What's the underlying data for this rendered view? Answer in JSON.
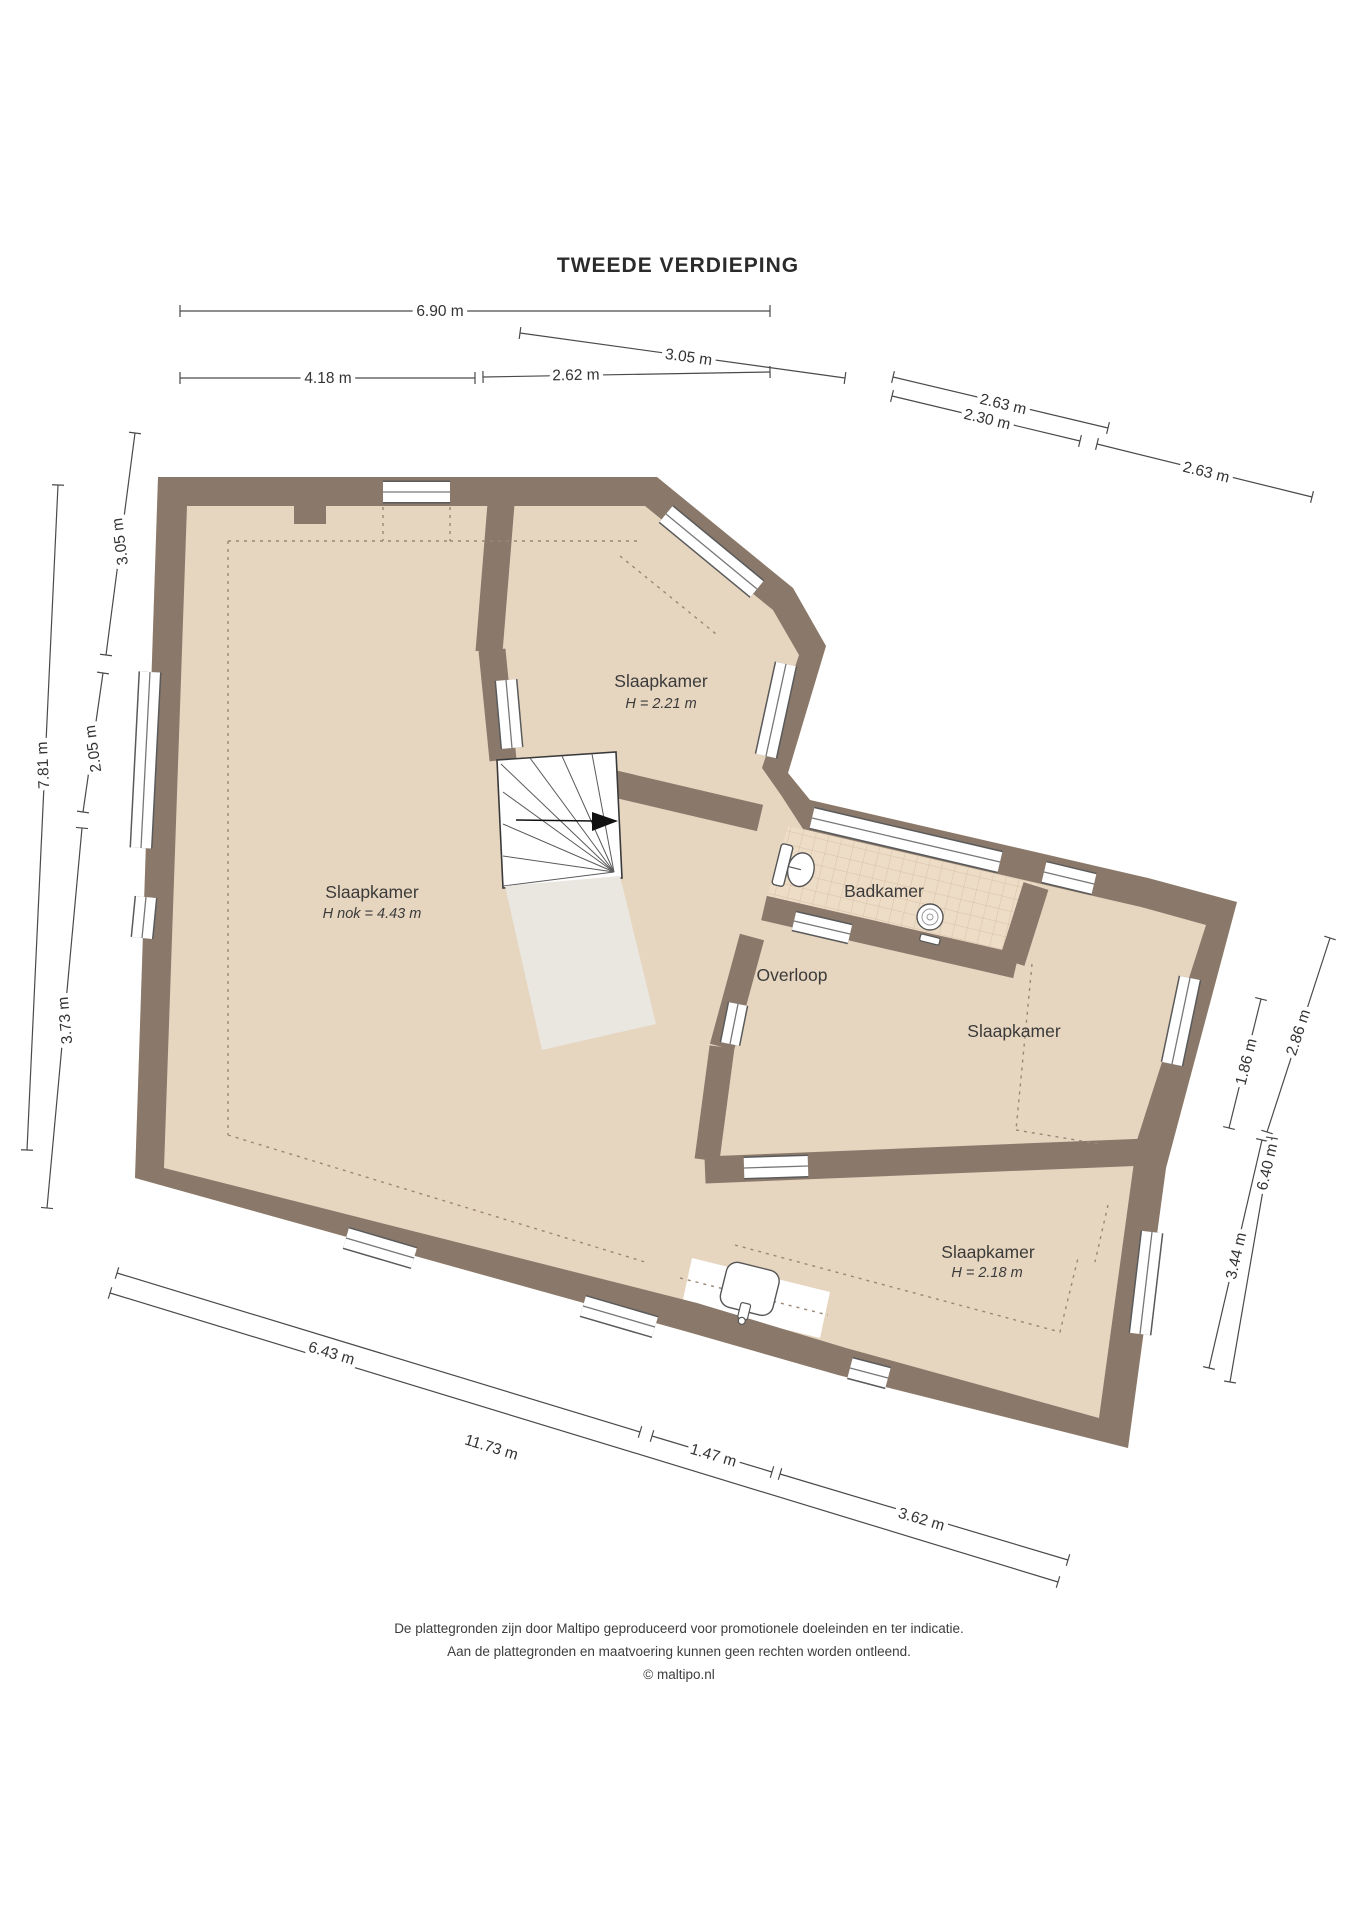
{
  "title": "TWEEDE VERDIEPING",
  "rooms": {
    "main_bedroom": {
      "label": "Slaapkamer",
      "sub": "H nok = 4.43 m"
    },
    "top_bedroom": {
      "label": "Slaapkamer",
      "sub": "H = 2.21 m"
    },
    "bathroom": {
      "label": "Badkamer"
    },
    "landing": {
      "label": "Overloop"
    },
    "right_bedroom": {
      "label": "Slaapkamer"
    },
    "bottom_bedroom": {
      "label": "Slaapkamer",
      "sub": "H = 2.18 m"
    }
  },
  "dims": [
    "6.90 m",
    "4.18 m",
    "2.62 m",
    "3.05 m",
    "2.63 m",
    "2.30 m",
    "2.63 m",
    "3.05 m",
    "7.81 m",
    "2.05 m",
    "3.73 m",
    "6.43 m",
    "11.73 m",
    "1.47 m",
    "3.62 m",
    "1.86 m",
    "2.86 m",
    "3.44 m",
    "6.40 m"
  ],
  "footer": {
    "line1": "De plattegronden zijn door Maltipo geproduceerd voor promotionele doeleinden en ter indicatie.",
    "line2": "Aan de plattegronden en maatvoering kunnen geen rechten worden ontleend.",
    "line3": "© maltipo.nl"
  },
  "colors": {
    "wall": "#8a796b",
    "floor": "#e6d5bf",
    "tile": "#eddcc6",
    "tileLine": "#d9c2a9",
    "landing": "#eae7e1",
    "white": "#ffffff"
  }
}
